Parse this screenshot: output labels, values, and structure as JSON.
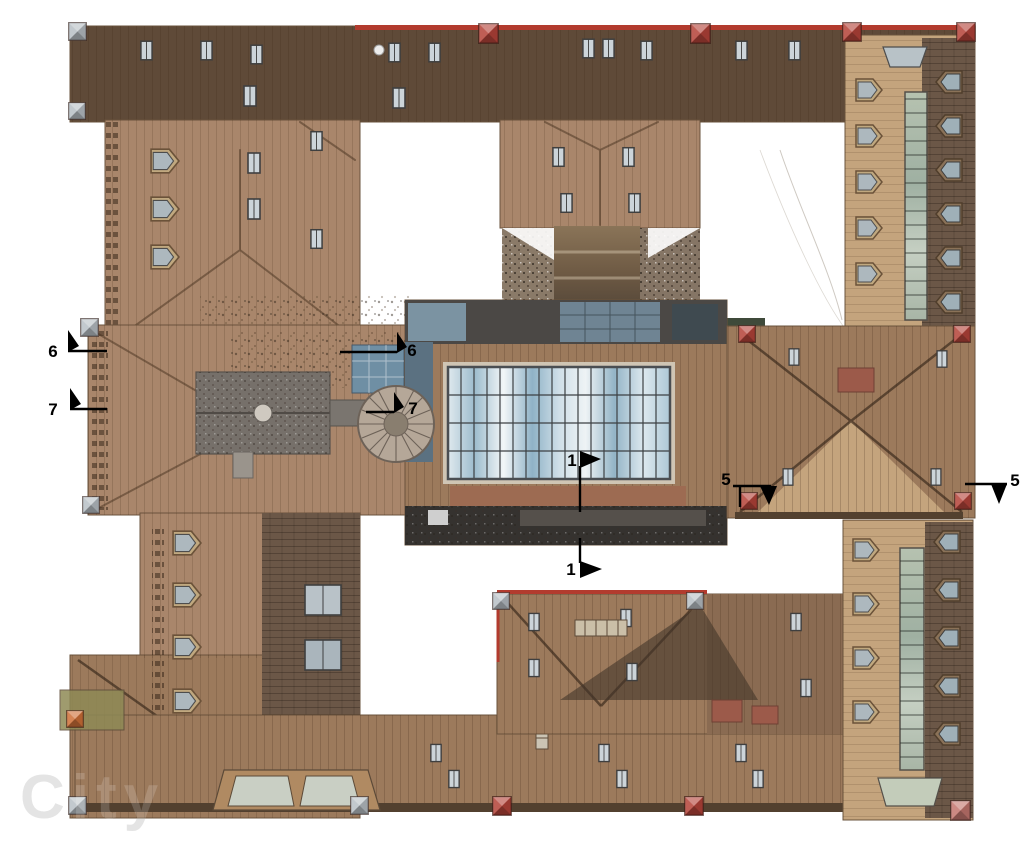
{
  "watermark": {
    "text": "City"
  },
  "markers": [
    {
      "id": "section-6-left",
      "label": "6"
    },
    {
      "id": "section-7-left",
      "label": "7"
    },
    {
      "id": "section-6-right",
      "label": "6"
    },
    {
      "id": "section-7-right",
      "label": "7"
    },
    {
      "id": "section-1-top",
      "label": "1"
    },
    {
      "id": "section-1-bottom",
      "label": "1"
    },
    {
      "id": "section-5-left",
      "label": "5"
    },
    {
      "id": "section-5-right",
      "label": "5"
    }
  ],
  "palette": {
    "background": "#ffffff",
    "roof_brown": "#9c7a5c",
    "roof_brown_dark": "#5f4a38",
    "roof_mid": "#a9866b",
    "roof_tan_light": "#c4a47d",
    "roof_shingle_dark": "#6b5747",
    "flat_roof_dark": "#3a3633",
    "church_gray": "#76706a",
    "dome_beige": "#b5a798",
    "ridge_red": "#b23b2e",
    "tarp_blue": "#6f8fa4",
    "glass_blue": "#aac6d6",
    "glass_green": "#a9b6a4",
    "mullion_dark": "#3c4043",
    "turret_red": "#b5443a",
    "turret_pink": "#c4766f",
    "turret_orange": "#cf7038",
    "turret_gray": "#b9c0c6",
    "marker_black": "#000000",
    "watermark_gray": "#cbcbcb"
  }
}
